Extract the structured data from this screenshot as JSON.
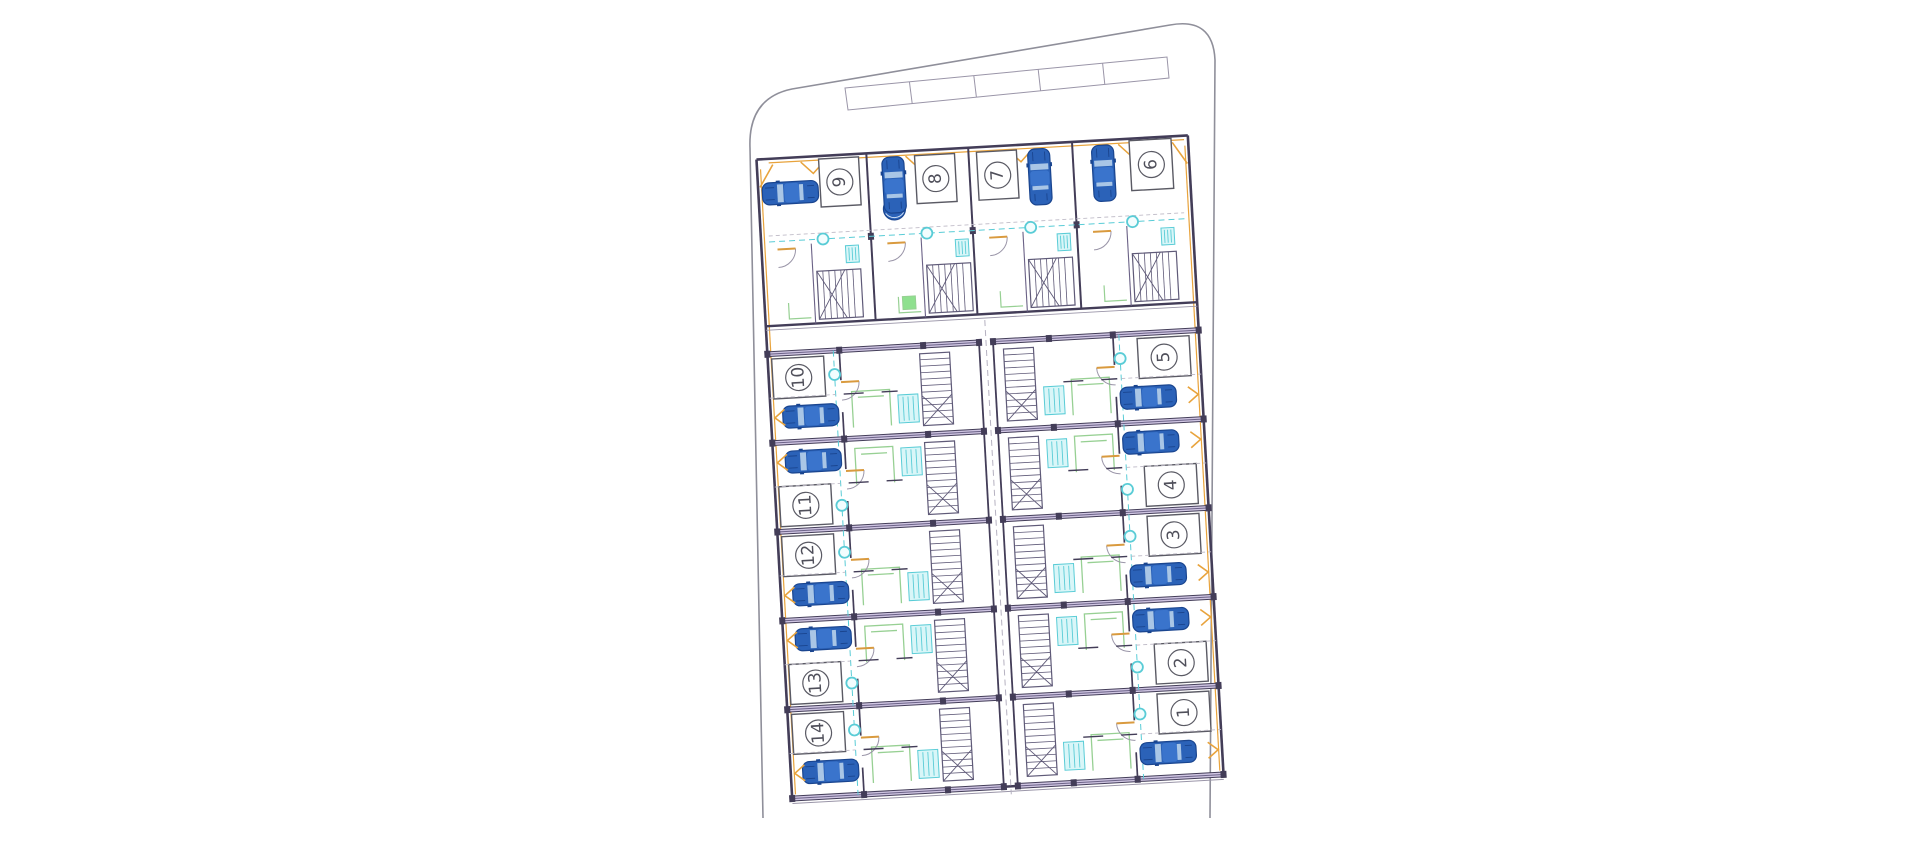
{
  "plan": {
    "kind": "residential-site-plan",
    "unit_count": 14
  },
  "colors": {
    "boundary": "#8f8f9a",
    "thin_line": "#9a95a8",
    "wall_dark": "#433d58",
    "wall_lilac": "#cfc5e2",
    "wall_purple": "#6a6186",
    "accent_orange": "#e8a33c",
    "door_tan": "#d99a3e",
    "fixture_cyan": "#59ccd6",
    "fixture_cyan_fill": "#d9f6f8",
    "furniture_green": "#97d093",
    "car_blue": "#2b62b8",
    "car_blue_dark": "#1a458f",
    "car_roof": "#3a74cc",
    "car_window": "#a9c6e6",
    "stair_stroke": "#5f5a78",
    "label_color": "#4f4f5a",
    "dash_gray": "#c0bcc8"
  },
  "units": [
    {
      "id": "u9",
      "label": "9",
      "zone": "garage-row",
      "bay": 0,
      "arrangement": "car-then-plate",
      "car_orientation": "horizontal"
    },
    {
      "id": "u8",
      "label": "8",
      "zone": "garage-row",
      "bay": 1,
      "arrangement": "car-then-plate",
      "car_orientation": "vertical"
    },
    {
      "id": "u7",
      "label": "7",
      "zone": "garage-row",
      "bay": 2,
      "arrangement": "plate-then-car",
      "car_orientation": "vertical"
    },
    {
      "id": "u6",
      "label": "6",
      "zone": "garage-row",
      "bay": 3,
      "arrangement": "car-then-plate",
      "car_orientation": "vertical"
    },
    {
      "id": "u10",
      "label": "10",
      "zone": "left-column",
      "row": 0,
      "arrangement": "plate-then-car",
      "car_orientation": "horizontal"
    },
    {
      "id": "u11",
      "label": "11",
      "zone": "left-column",
      "row": 1,
      "arrangement": "car-then-plate",
      "car_orientation": "horizontal"
    },
    {
      "id": "u12",
      "label": "12",
      "zone": "left-column",
      "row": 2,
      "arrangement": "plate-then-car",
      "car_orientation": "horizontal"
    },
    {
      "id": "u13",
      "label": "13",
      "zone": "left-column",
      "row": 3,
      "arrangement": "car-then-plate",
      "car_orientation": "horizontal"
    },
    {
      "id": "u14",
      "label": "14",
      "zone": "left-column",
      "row": 4,
      "arrangement": "plate-then-car",
      "car_orientation": "horizontal"
    },
    {
      "id": "u5",
      "label": "5",
      "zone": "right-column",
      "row": 0,
      "arrangement": "plate-then-car",
      "car_orientation": "horizontal"
    },
    {
      "id": "u4",
      "label": "4",
      "zone": "right-column",
      "row": 1,
      "arrangement": "car-then-plate",
      "car_orientation": "horizontal"
    },
    {
      "id": "u3",
      "label": "3",
      "zone": "right-column",
      "row": 2,
      "arrangement": "plate-then-car",
      "car_orientation": "horizontal"
    },
    {
      "id": "u2",
      "label": "2",
      "zone": "right-column",
      "row": 3,
      "arrangement": "car-then-plate",
      "car_orientation": "horizontal"
    },
    {
      "id": "u1",
      "label": "1",
      "zone": "right-column",
      "row": 4,
      "arrangement": "plate-then-car",
      "car_orientation": "horizontal"
    }
  ]
}
